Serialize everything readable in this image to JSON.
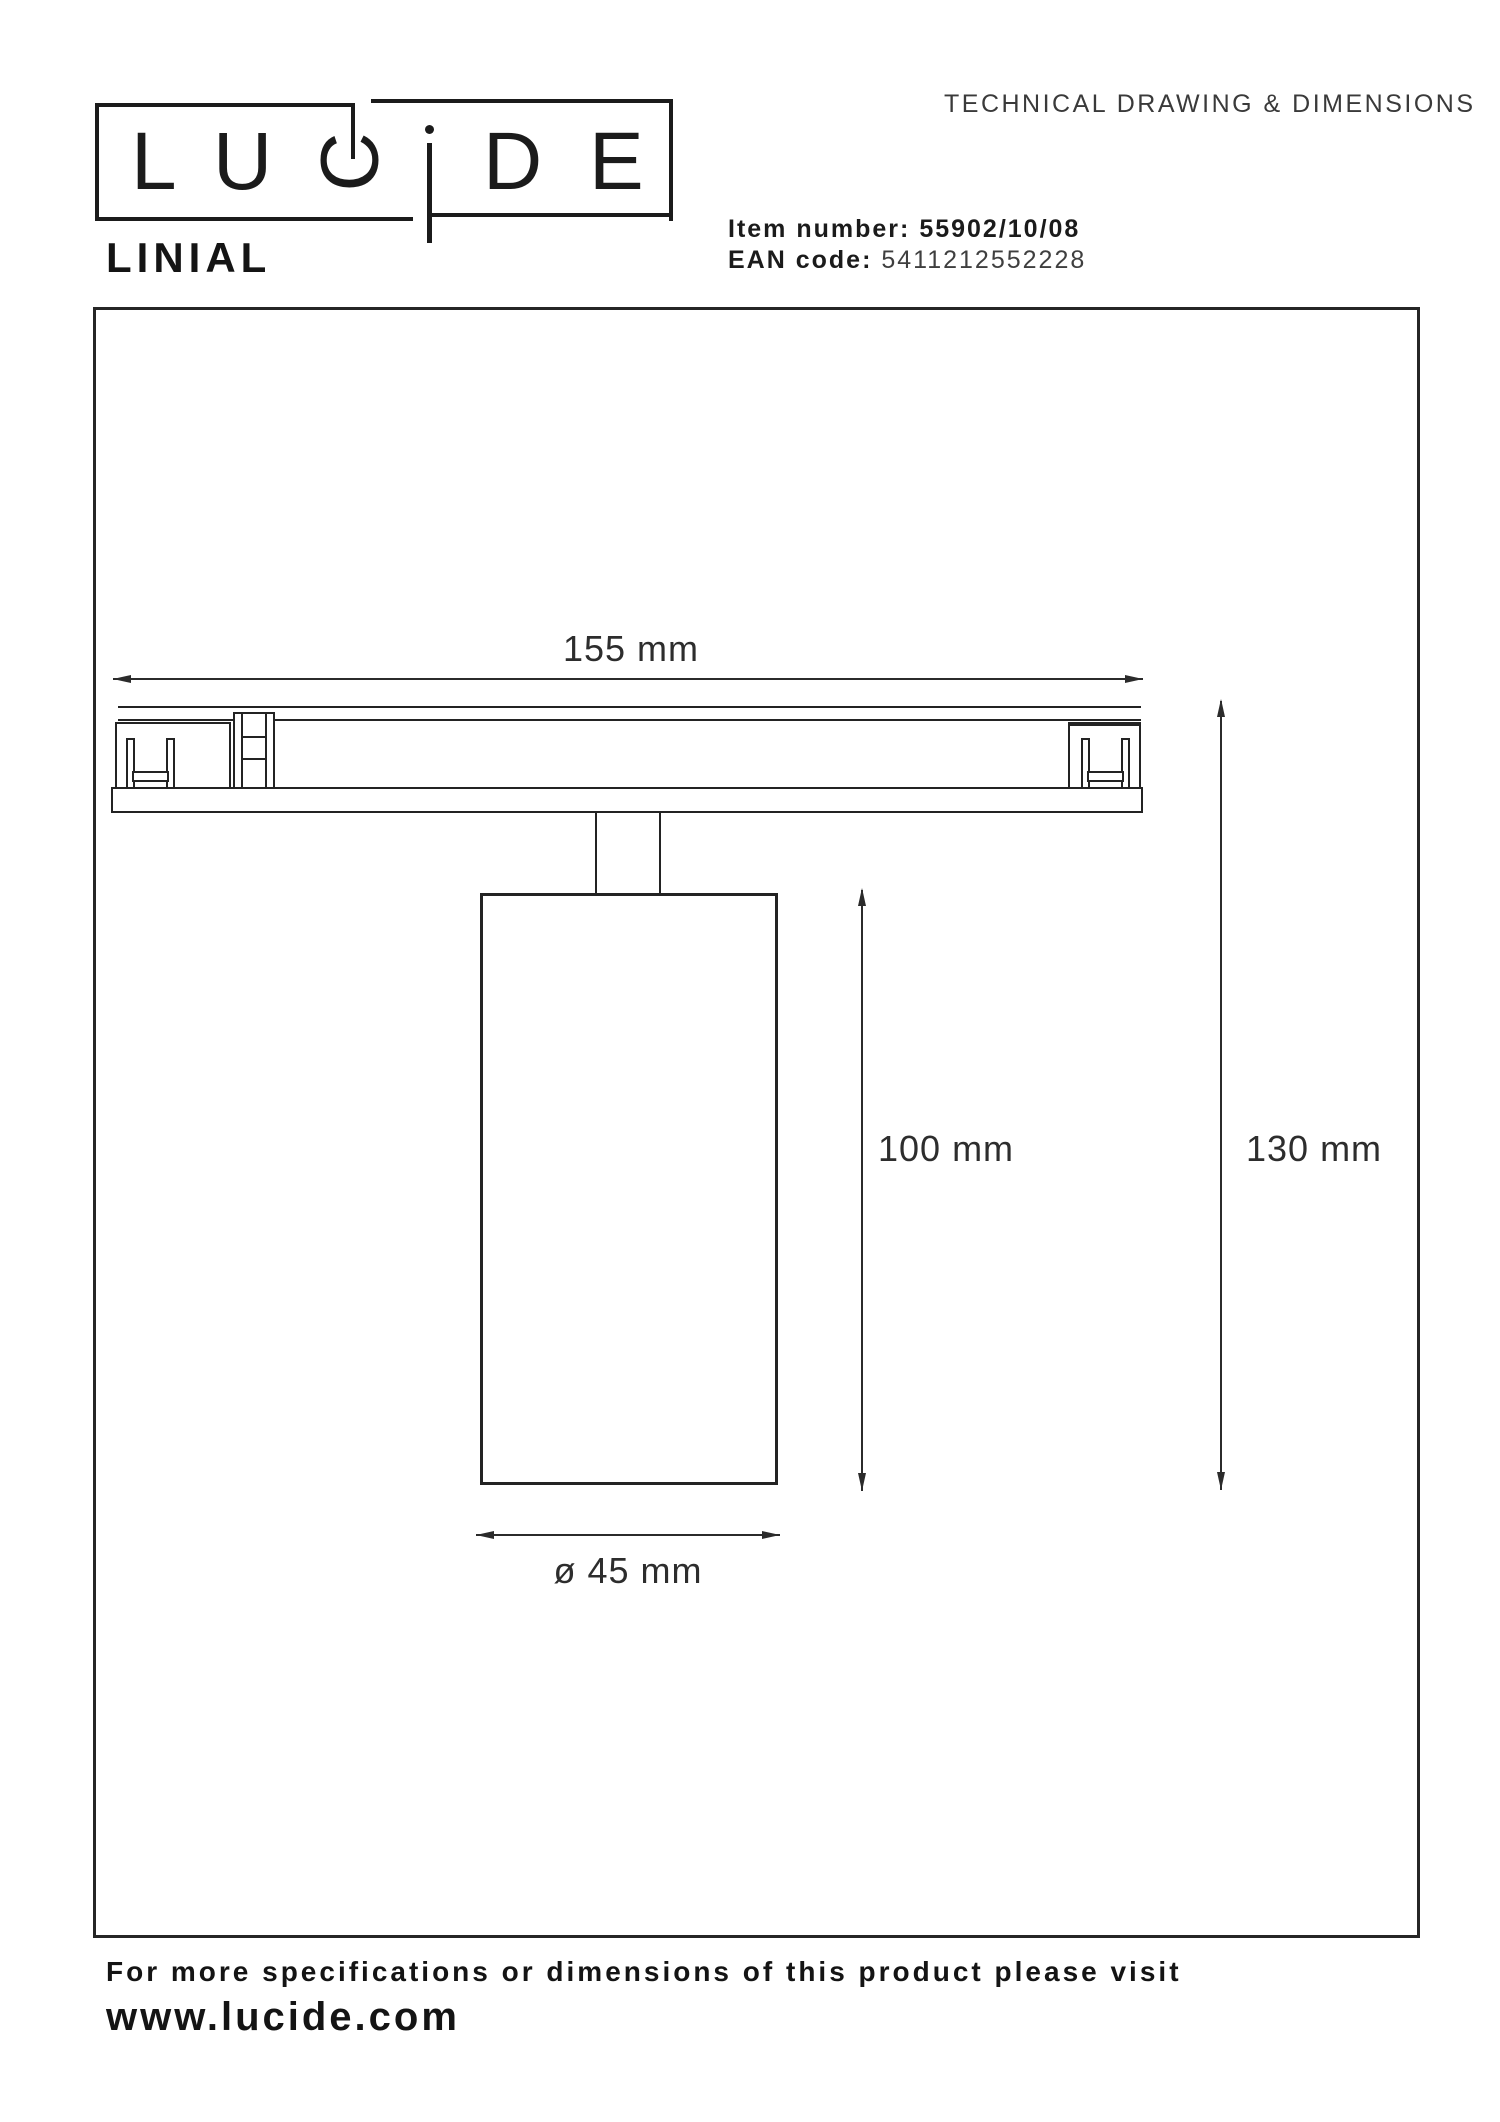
{
  "colors": {
    "ink": "#1f1f1f",
    "muted_text": "#3a3a3a",
    "background": "#ffffff"
  },
  "header": {
    "logo_letters": {
      "l1": "L",
      "l2": "U",
      "l3": "C",
      "l4": "i",
      "l5": "D",
      "l6": "E"
    },
    "doc_title": "TECHNICAL DRAWING & DIMENSIONS"
  },
  "product": {
    "name": "LINIAL",
    "item_label": "Item number:",
    "item_value": "55902/10/08",
    "ean_label": "EAN code:",
    "ean_value": "5411212552228"
  },
  "drawing": {
    "track_width": "155 mm",
    "spot_height": "100 mm",
    "total_height": "130 mm",
    "diameter": "ø 45 mm"
  },
  "footer": {
    "line1": "For more specifications or dimensions of this product please visit",
    "line2": "www.lucide.com"
  }
}
